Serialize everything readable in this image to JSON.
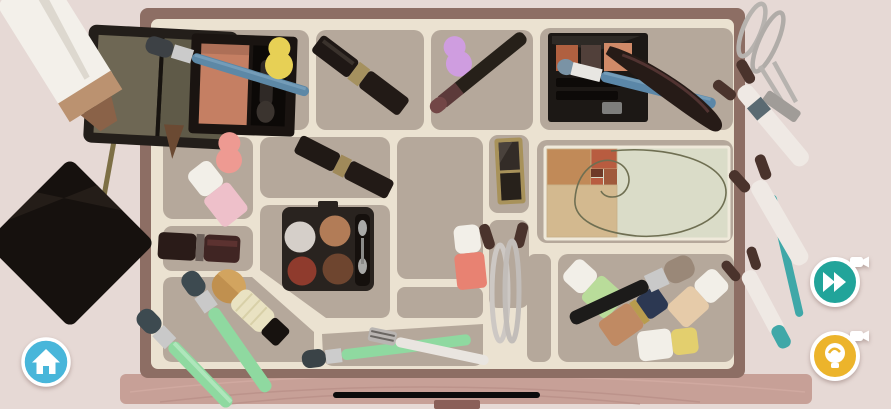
{
  "app": {
    "type": "mobile-puzzle-game",
    "scene": "makeup-drawer-organization",
    "orientation": "landscape"
  },
  "colors": {
    "background": "#e6d9d5",
    "drawer_frame": "#8d6e64",
    "drawer_panel": "#ebe2d1",
    "compartment": "#b5a89b",
    "wood_front": "#c7a097",
    "wood_grain_dark": "#b48b83",
    "wood_grain_light": "#d4aca4",
    "wood_tab": "#8a5f58"
  },
  "hud": {
    "home_button": {
      "icon": "home",
      "color": "#48b6da",
      "ring": "#ffffff"
    },
    "skip_button": {
      "icon": "fast-forward",
      "badge": "video-ad",
      "color": "#21a49a",
      "ring": "#ffffff"
    },
    "hint_button": {
      "icon": "lightbulb",
      "badge": "video-ad",
      "color": "#ecb42b",
      "ring": "#ffffff"
    },
    "home_indicator": {
      "color": "#0b0b0b"
    }
  },
  "reference_card": {
    "name": "golden-ratio-spiral-card",
    "background": "#dadcc8",
    "square_large": "#c18a58",
    "square_red": "#b85c40",
    "square_small_1": "#a05a3c",
    "square_small_2": "#6e3a28",
    "square_tan": "#d3b98f",
    "spiral_color": "#6f6f52",
    "border": "#efe9da"
  },
  "drawer": {
    "compartment_count": 16
  },
  "items": {
    "foundation_tube": {
      "color": "#f3f0ea",
      "band": "#bb9270",
      "neck": "#8a6248"
    },
    "liner_brush": {
      "color": "#7d6f45",
      "tip": "#574435"
    },
    "black_compact": {
      "color": "#16110e",
      "sheen": "#241d18"
    },
    "olive_eyeshadow_compact": {
      "color": "#231e1a",
      "pan_left": "#6e6754",
      "pan_right": "#5f5a48"
    },
    "blush_palette": {
      "color": "#1a1411",
      "blush": "#c57f63"
    },
    "blue_makeup_brush": {
      "handle": "#5d88a6",
      "tuft": "#3d4145",
      "ferrule": "#cbcbcb"
    },
    "yellow_sponge": {
      "color": "#e7d055"
    },
    "pink_sponge": {
      "color": "#ee9a92"
    },
    "purple_sponge": {
      "color": "#cf9de0"
    },
    "lipstick_top": {
      "color": "#221a16",
      "band": "#a5915f"
    },
    "lipstick_middle": {
      "color": "#221a16",
      "band": "#a08a5a"
    },
    "lipstick_small": {
      "color": "#402523",
      "cap": "#2a1b18"
    },
    "eyeliner_pencil": {
      "color": "#262019",
      "tip": "#5c3a3a"
    },
    "brow_palette": {
      "color": "#1c1815",
      "pan_rust": "#b06040",
      "pan_dark": "#51403a",
      "pan_peach": "#d08a68"
    },
    "blue_eyeliner_pencil": {
      "color": "#5b87a8",
      "tuft": "#7a93a5"
    },
    "lash_tool": {
      "color": "#261b17",
      "sheen": "#5c3a38"
    },
    "quad_eyeshadow_palette": {
      "color": "#29231f",
      "pan_white": "#d5cfc9",
      "pan_tan": "#b27c57",
      "pan_red": "#8f3b2d",
      "pan_brown": "#6e452f"
    },
    "gold_trim_duo": {
      "color": "#332c27",
      "trim": "#a8925a"
    },
    "eyelash_curler_small": {
      "color": "#cdc8c4",
      "grip": "#4a332c"
    },
    "eyelash_curler_hanging": {
      "color": "#b7b3af",
      "clamp": "#a09c98"
    },
    "coral_nail_polish": {
      "color": "#e88272",
      "cap": "#f2efe8"
    },
    "pink_nail_polish": {
      "color": "#eec0ca",
      "cap": "#f2efe8"
    },
    "green_nail_polish": {
      "color": "#b9dc9a",
      "cap": "#f2efe8"
    },
    "copper_nail_polish": {
      "color": "#c08a63",
      "cap": "#2c3852",
      "band": "#b89c4e"
    },
    "beige_nail_polish": {
      "color": "#e6cba9",
      "cap": "#f2efe8"
    },
    "white_nail_polish": {
      "color": "#f2efe8",
      "cap": "#e3cf6e"
    },
    "powder_brush": {
      "handle": "#1c1b1a",
      "bristles": "#9a8878"
    },
    "kabuki_brush": {
      "color": "#e9e2c2",
      "bristles": "#c0904f",
      "cap": "#17120f"
    },
    "mint_brush_1": {
      "handle": "#8fd9a0",
      "tuft": "#3d4a50"
    },
    "mint_brush_2": {
      "handle": "#8fd9a0",
      "tuft": "#3d4a50"
    },
    "mint_brush_3": {
      "handle": "#8fd9a0",
      "tuft": "#3a4347"
    },
    "razor": {
      "color": "#e9e5e0",
      "head": "#b9b5b2"
    },
    "hanging_brush_1": {
      "color": "#efe9e4",
      "tip": "#4a332c",
      "band": "#5a6a72"
    },
    "hanging_brush_2": {
      "color": "#efe9e4",
      "tip": "#4a332c"
    },
    "hanging_brush_3": {
      "color": "#efe9e4",
      "tip": "#4a332c"
    },
    "teal_pencil": {
      "color": "#3fa8a8"
    }
  }
}
